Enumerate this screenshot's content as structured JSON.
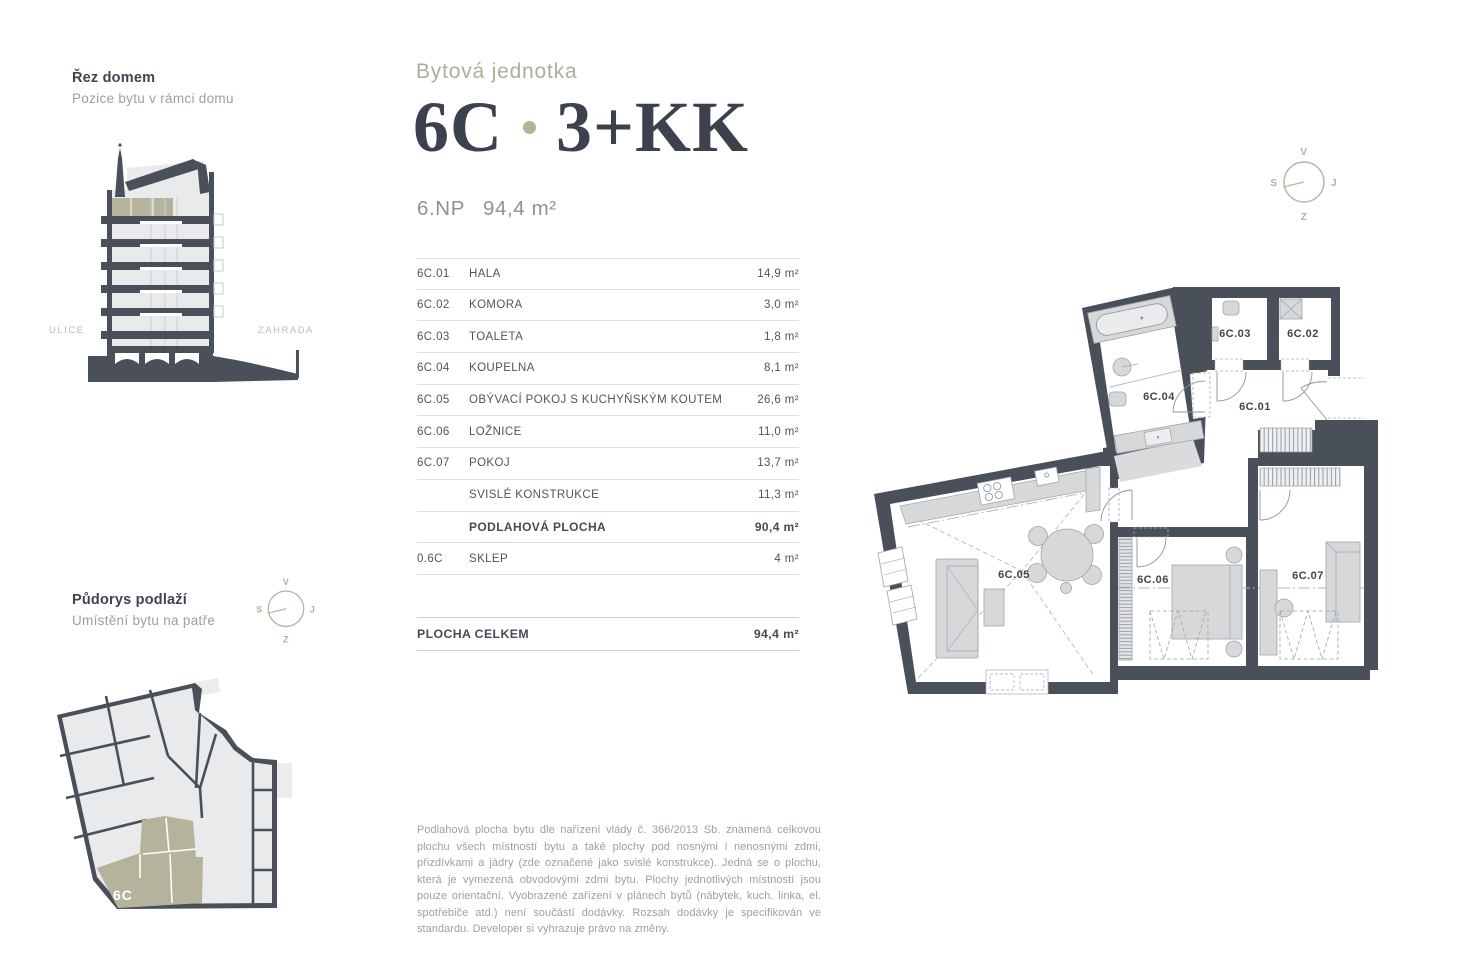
{
  "colors": {
    "wall_dark": "#4a505a",
    "accent_beige": "#b5b29b",
    "furniture_gray": "#d6d8da",
    "text_dark": "#3b424d",
    "text_gray": "#9aa0a6"
  },
  "section_view": {
    "title": "Řez domem",
    "subtitle": "Pozice bytu v rámci domu",
    "street_label": "ULICE",
    "garden_label": "ZAHRADA"
  },
  "floor_view": {
    "title": "Půdorys podlaží",
    "subtitle": "Umístění bytu na patře",
    "unit_label": "6C"
  },
  "header": {
    "eyebrow": "Bytová jednotka",
    "unit": "6C",
    "separator": "·",
    "layout": "3+KK",
    "floor": "6.NP",
    "area": "94,4 m²"
  },
  "table": {
    "rows": [
      {
        "code": "6C.01",
        "name": "HALA",
        "area": "14,9 m²"
      },
      {
        "code": "6C.02",
        "name": "KOMORA",
        "area": "3,0 m²"
      },
      {
        "code": "6C.03",
        "name": "TOALETA",
        "area": "1,8 m²"
      },
      {
        "code": "6C.04",
        "name": "KOUPELNA",
        "area": "8,1 m²"
      },
      {
        "code": "6C.05",
        "name": "OBÝVACÍ POKOJ S KUCHYŇSKÝM KOUTEM",
        "area": "26,6 m²"
      },
      {
        "code": "6C.06",
        "name": "LOŽNICE",
        "area": "11,0 m²"
      },
      {
        "code": "6C.07",
        "name": "POKOJ",
        "area": "13,7 m²"
      },
      {
        "code": "",
        "name": "SVISLÉ KONSTRUKCE",
        "area": "11,3 m²"
      },
      {
        "code": "",
        "name": "PODLAHOVÁ PLOCHA",
        "area": "90,4 m²"
      },
      {
        "code": "0.6C",
        "name": "SKLEP",
        "area": "4 m²"
      }
    ],
    "total": {
      "label": "PLOCHA CELKEM",
      "area": "94,4 m²"
    }
  },
  "compass": {
    "top": "V",
    "right": "J",
    "bottom": "Z",
    "left": "S"
  },
  "plan": {
    "labels": {
      "r01": "6C.01",
      "r02": "6C.02",
      "r03": "6C.03",
      "r04": "6C.04",
      "r05": "6C.05",
      "r06": "6C.06",
      "r07": "6C.07"
    }
  },
  "disclaimer": "Podlahová plocha bytu dle nařízení vlády č. 366/2013 Sb. znamená celkovou plochu všech místností bytu a také plochy pod nosnými i nenosnými zdmi, přizdívkami a jádry (zde označené jako svislé konstrukce). Jedná se o plochu, která je vymezená obvodovými zdmi bytu. Plochy jednotlivých místností jsou pouze orientační. Vyobrazené zařízení v plánech bytů (nábytek, kuch. linka, el. spotřebiče atd.) není součástí dodávky. Rozsah dodávky je specifikován ve standardu. Developer si vyhrazuje právo na změny."
}
